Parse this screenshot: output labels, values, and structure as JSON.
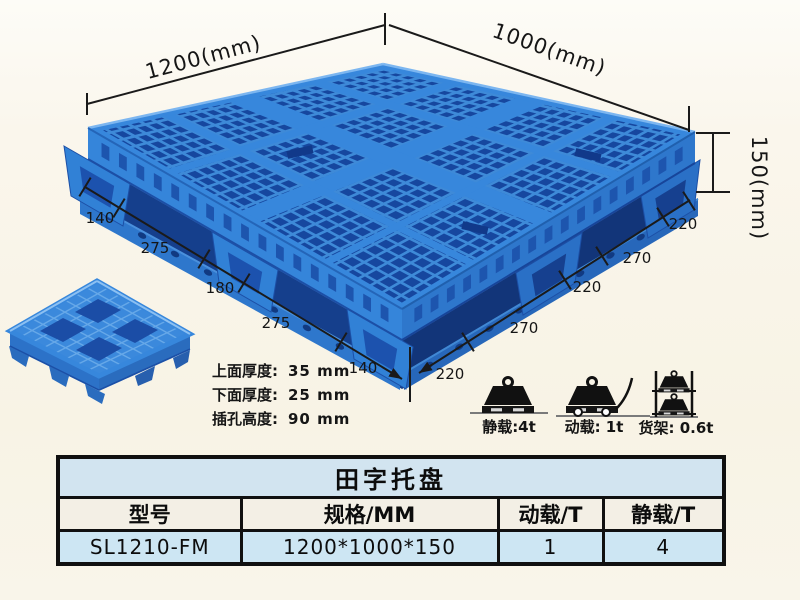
{
  "dimension_labels": {
    "length": "1200(mm)",
    "width": "1000(mm)",
    "height": "150(mm)",
    "left_chain": [
      "140",
      "275",
      "180",
      "275",
      "140"
    ],
    "right_chain": [
      "220",
      "270",
      "220",
      "270",
      "220"
    ]
  },
  "thickness_specs": [
    {
      "label": "上面厚度:",
      "value": "35 mm"
    },
    {
      "label": "下面厚度:",
      "value": "25 mm"
    },
    {
      "label": "插孔高度:",
      "value": "90 mm"
    }
  ],
  "load_ratings": [
    {
      "icon": "static-load-icon",
      "label": "静载:4t"
    },
    {
      "icon": "dynamic-load-icon",
      "label": "动载: 1t"
    },
    {
      "icon": "rack-load-icon",
      "label": "货架: 0.6t"
    }
  ],
  "spec_table": {
    "title": "田字托盘",
    "headers": [
      "型号",
      "规格/MM",
      "动载/T",
      "静载/T"
    ],
    "rows": [
      [
        "SL1210-FM",
        "1200*1000*150",
        "1",
        "4"
      ]
    ]
  },
  "colors": {
    "background": "#f9f5ea",
    "pallet_blue": "#3585da",
    "pallet_dark_blue": "#16479f",
    "pallet_light_blue": "#4e9ae0",
    "dimension_line": "#1a1a1a",
    "table_title_bg": "#d2e4f0",
    "table_header_bg": "#f3efe5",
    "table_data_bg": "#cde6f3"
  }
}
